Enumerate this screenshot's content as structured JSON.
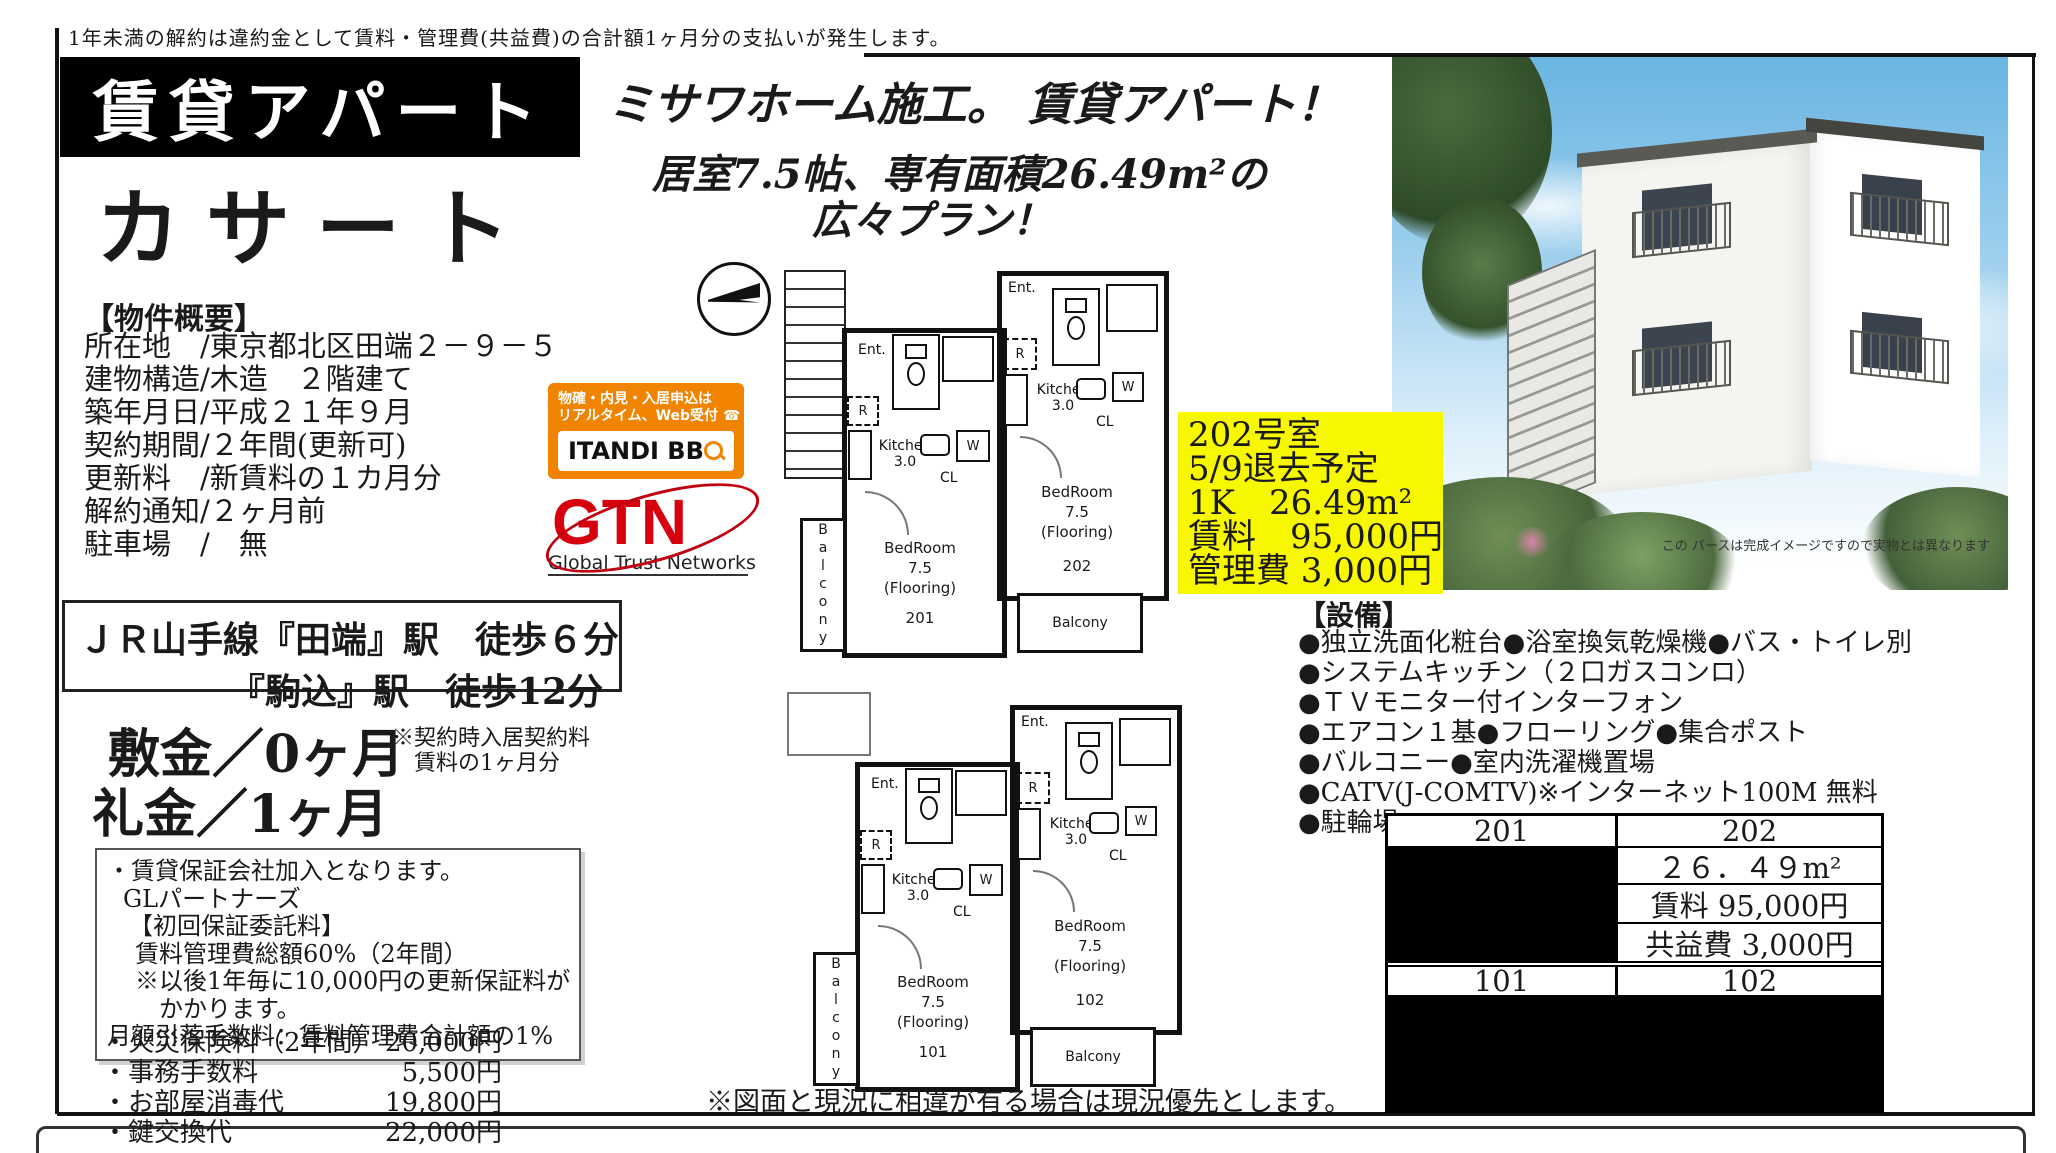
{
  "top": {
    "disclaimer": "1年未満の解約は違約金として賃料・管理費(共益費)の合計額1ヶ月分の支払いが発生します。"
  },
  "title": {
    "category": "賃貸アパート",
    "name": "カサート"
  },
  "headline": {
    "line1": "ミサワホーム施工。 賃貸アパート！",
    "line2": "居室7.5帖、専有面積26.49m²の",
    "line3": "広々プラン！"
  },
  "overview": {
    "heading": "【物件概要】",
    "lines": [
      "所在地　/東京都北区田端２－９－５",
      "建物構造/木造　２階建て",
      "築年月日/平成２１年９月",
      "契約期間/２年間(更新可)",
      "更新料　/新賃料の１カ月分",
      "解約通知/２ヶ月前",
      "駐車場　/　無"
    ]
  },
  "access": {
    "line1": "ＪＲ山手線『田端』駅　徒歩６分",
    "line2": "『駒込』駅　徒歩12分"
  },
  "deposit": {
    "shikikin": "敷金／0ヶ月",
    "reikin": "礼金／1ヶ月",
    "note1": "※契約時入居契約料",
    "note2": "賃料の1ヶ月分"
  },
  "guarantee": {
    "lines": [
      "・賃貸保証会社加入となります。",
      "GLパートナーズ",
      "【初回保証委託料】",
      "賃料管理費総額60%（2年間）",
      "※以後1年毎に10,000円の更新保証料が",
      "かかります。",
      "月額引落手数料：賃料管理費合計額の1%"
    ]
  },
  "fees": {
    "items": [
      {
        "label": "・火災保険料（2年間）",
        "price": "20,000円"
      },
      {
        "label": "・事務手数料",
        "price": "5,500円"
      },
      {
        "label": "・お部屋消毒代",
        "price": "19,800円"
      },
      {
        "label": "・鍵交換代",
        "price": "22,000円"
      }
    ]
  },
  "itandi": {
    "line1": "物確・内見・入居申込は",
    "line2": "リアルタイム、Web受付",
    "brand": "ITANDI BB"
  },
  "icons": {
    "phone_glyph": "☎"
  },
  "gtn": {
    "brand": "GTN",
    "sub": "Global Trust Networks"
  },
  "highlight": {
    "lines": [
      "202号室",
      "5/9退去予定",
      "1K　26.49m²",
      "賃料　95,000円",
      "管理費 3,000円"
    ]
  },
  "equipment": {
    "heading": "【設備】",
    "lines": [
      "●独立洗面化粧台●浴室換気乾燥機●バス・トイレ別",
      "●システムキッチン（２口ガスコンロ）",
      "●ＴＶモニター付インターフォン",
      "●エアコン１基●フローリング●集合ポスト",
      "●バルコニー●室内洗濯機置場",
      "●CATV(J-COMTV)※インターネット100M 無料",
      "●駐輪場"
    ]
  },
  "price_table": {
    "unit_201": "201",
    "unit_202": "202",
    "area": "２６．４９m²",
    "rent": "賃料 95,000円",
    "common_fee": "共益費 3,000円",
    "unit_101": "101",
    "unit_102": "102"
  },
  "floorplan": {
    "labels": {
      "ent": "Ent.",
      "r": "R",
      "kitchen": "Kitchen",
      "kitchen_size": "3.0",
      "cl": "CL",
      "w": "W",
      "bedroom": "BedRoom",
      "bedroom_size": "7.5",
      "flooring": "(Flooring)",
      "balcony": "Balcony"
    },
    "units": {
      "u201": "201",
      "u202": "202",
      "u101": "101",
      "u102": "102"
    },
    "note": "※図面と現況に相違が有る場合は現況優先とします。"
  },
  "photo": {
    "caption": "この パースは完成イメージですので実物とは異なります"
  }
}
